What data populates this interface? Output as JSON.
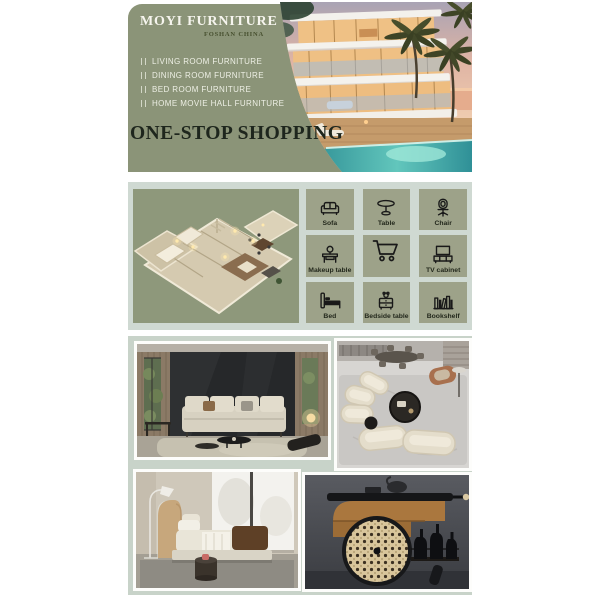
{
  "header": {
    "brand": "MOYI FURNITURE",
    "location": "FOSHAN CHINA",
    "menu_items": [
      "LIVING ROOM FURNITURE",
      "DINING ROOM FURNITURE",
      "BED ROOM FURNITURE",
      "HOME MOVIE HALL FURNITURE"
    ],
    "headline": "ONE-STOP SHOPPING"
  },
  "categories": {
    "items": [
      {
        "label": "Sofa",
        "icon": "sofa-icon"
      },
      {
        "label": "Table",
        "icon": "round-table-icon"
      },
      {
        "label": "Chair",
        "icon": "desk-chair-icon"
      },
      {
        "label": "Makeup table",
        "icon": "makeup-table-icon"
      },
      {
        "label": "",
        "icon": "shopping-cart-icon"
      },
      {
        "label": "TV cabinet",
        "icon": "tv-cabinet-icon"
      },
      {
        "label": "Bed",
        "icon": "bed-icon"
      },
      {
        "label": "Bedside table",
        "icon": "bedside-table-icon"
      },
      {
        "label": "Bookshelf",
        "icon": "bookshelf-icon"
      }
    ]
  },
  "illustrations": {
    "hero_photo": "modern-villa-at-dusk-with-pool-and-palms",
    "floor_plan": "3d-apartment-floor-plan"
  },
  "gallery": {
    "photos": [
      {
        "name": "living-room-black-accent-wall-beige-sofa"
      },
      {
        "name": "top-view-curved-beige-sofa-set"
      },
      {
        "name": "bedroom-upholstered-bed-floor-lamp"
      },
      {
        "name": "wooden-bar-cart-cane-wheel-bottles"
      }
    ]
  },
  "colors": {
    "panel_green": "#8b9478",
    "tile_green": "#9da289",
    "section_light": "#cfd9d2",
    "gallery_light": "#c8d3c9",
    "headline_dark": "#1e261d",
    "title_white": "#f6f5ee"
  }
}
